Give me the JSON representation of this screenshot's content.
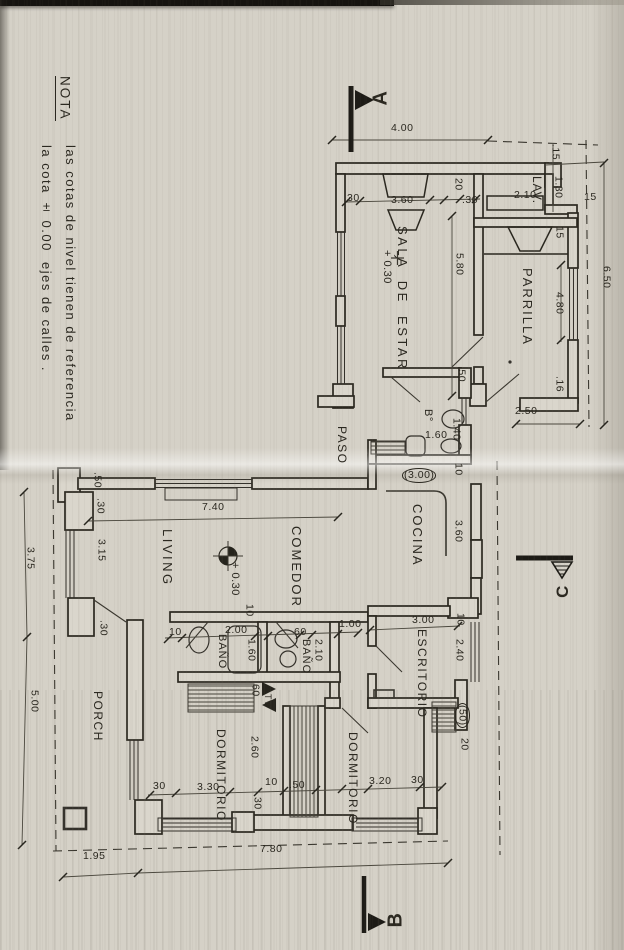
{
  "note": {
    "title": "NOTA",
    "line1": "las cotas de nivel tienen de referencia",
    "line2": "la cota ± 0.00  ejes de calles ."
  },
  "markers": {
    "a": "A",
    "b": "B",
    "c": "C"
  },
  "colors": {
    "ink": "#2b2820",
    "paper": "#d5d1c7"
  },
  "rooms": [
    {
      "t": "SALA  DE  ESTAR",
      "x": 396,
      "y": 226,
      "fs": 13,
      "ls": 2.5,
      "name": "room-label-sala-de-estar"
    },
    {
      "t": "LAV.",
      "x": 531,
      "y": 176,
      "fs": 12,
      "ls": 1,
      "name": "room-label-lavadero"
    },
    {
      "t": "PARRILLA",
      "x": 521,
      "y": 268,
      "fs": 13,
      "ls": 2,
      "name": "room-label-parrilla"
    },
    {
      "t": "PASO",
      "x": 336,
      "y": 426,
      "fs": 12,
      "ls": 1.5,
      "name": "room-label-paso"
    },
    {
      "t": "B°",
      "x": 422,
      "y": 409,
      "fs": 11,
      "ls": 0.5,
      "name": "room-label-banio-chico"
    },
    {
      "t": "COCINA",
      "x": 411,
      "y": 504,
      "fs": 13,
      "ls": 2,
      "name": "room-label-cocina"
    },
    {
      "t": "COMEDOR",
      "x": 290,
      "y": 526,
      "fs": 13,
      "ls": 2,
      "name": "room-label-comedor"
    },
    {
      "t": "LIVING",
      "x": 161,
      "y": 529,
      "fs": 13,
      "ls": 2.5,
      "name": "room-label-living"
    },
    {
      "t": "ESCRITORIO",
      "x": 416,
      "y": 629,
      "fs": 12,
      "ls": 1.5,
      "name": "room-label-escritorio"
    },
    {
      "t": "BAÑO",
      "x": 216,
      "y": 634,
      "fs": 11,
      "ls": 1,
      "name": "room-label-banio-1"
    },
    {
      "t": "BAÑO",
      "x": 300,
      "y": 639,
      "fs": 11,
      "ls": 1,
      "name": "room-label-banio-2"
    },
    {
      "t": "DORMITORIO",
      "x": 215,
      "y": 729,
      "fs": 12,
      "ls": 1.5,
      "name": "room-label-dormitorio-1"
    },
    {
      "t": "DORMITORIO",
      "x": 347,
      "y": 732,
      "fs": 12,
      "ls": 1.5,
      "name": "room-label-dormitorio-2"
    },
    {
      "t": "PORCH",
      "x": 92,
      "y": 691,
      "fs": 12,
      "ls": 1.5,
      "name": "room-label-porch"
    },
    {
      "t": "TV",
      "x": 263,
      "y": 694,
      "fs": 9,
      "ls": 0.5,
      "name": "label-tv-nook"
    }
  ],
  "levels": [
    {
      "t": "+ 0.30",
      "x": 381,
      "y": 250,
      "fs": 11,
      "name": "level-mark-sala"
    },
    {
      "t": "+ 0.30",
      "x": 229,
      "y": 562,
      "fs": 11,
      "name": "level-mark-living"
    }
  ],
  "dims_h": [
    {
      "t": "4.00",
      "x": 391,
      "y": 123
    },
    {
      "t": "30",
      "x": 347,
      "y": 193
    },
    {
      "t": "3.60",
      "x": 391,
      "y": 195
    },
    {
      "t": ".30",
      "x": 462,
      "y": 195
    },
    {
      "t": "2.10",
      "x": 514,
      "y": 190
    },
    {
      "t": "15",
      "x": 584,
      "y": 192
    },
    {
      "t": "2.50",
      "x": 515,
      "y": 406
    },
    {
      "t": "1.60",
      "x": 425,
      "y": 430
    },
    {
      "t": "(3.00)",
      "x": 402,
      "y": 468,
      "oval": true
    },
    {
      "t": "7.40",
      "x": 202,
      "y": 502
    },
    {
      "t": "10",
      "x": 169,
      "y": 627
    },
    {
      "t": "2.00",
      "x": 225,
      "y": 625
    },
    {
      "t": "60",
      "x": 294,
      "y": 627
    },
    {
      "t": "1.00",
      "x": 339,
      "y": 619
    },
    {
      "t": "3.00",
      "x": 412,
      "y": 615
    },
    {
      "t": "30",
      "x": 153,
      "y": 781
    },
    {
      "t": "3.30",
      "x": 197,
      "y": 782
    },
    {
      "t": "10",
      "x": 265,
      "y": 777
    },
    {
      "t": ".50",
      "x": 289,
      "y": 780
    },
    {
      "t": "3.20",
      "x": 369,
      "y": 776
    },
    {
      "t": "30",
      "x": 411,
      "y": 775
    },
    {
      "t": "1.95",
      "x": 83,
      "y": 851
    },
    {
      "t": "7.80",
      "x": 260,
      "y": 844
    }
  ],
  "dims_v": [
    {
      "t": ".15",
      "x": 550,
      "y": 144
    },
    {
      "t": "1.30",
      "x": 553,
      "y": 176
    },
    {
      "t": "15",
      "x": 554,
      "y": 226
    },
    {
      "t": "20",
      "x": 453,
      "y": 178
    },
    {
      "t": "5.80",
      "x": 454,
      "y": 253
    },
    {
      "t": ".50",
      "x": 456,
      "y": 366
    },
    {
      "t": "6.50",
      "x": 601,
      "y": 266
    },
    {
      "t": "4.80",
      "x": 554,
      "y": 292
    },
    {
      "t": ".16",
      "x": 554,
      "y": 376
    },
    {
      "t": "1.40",
      "x": 451,
      "y": 418
    },
    {
      "t": "10",
      "x": 453,
      "y": 463
    },
    {
      "t": "3.60",
      "x": 453,
      "y": 520
    },
    {
      "t": ".50",
      "x": 92,
      "y": 472
    },
    {
      "t": ".30",
      "x": 95,
      "y": 498
    },
    {
      "t": "3.15",
      "x": 96,
      "y": 539
    },
    {
      "t": ".30",
      "x": 98,
      "y": 620
    },
    {
      "t": "10",
      "x": 244,
      "y": 604
    },
    {
      "t": "1.60",
      "x": 246,
      "y": 639
    },
    {
      "t": "2.10",
      "x": 313,
      "y": 639
    },
    {
      "t": "60",
      "x": 250,
      "y": 684
    },
    {
      "t": "2.60",
      "x": 249,
      "y": 736
    },
    {
      "t": "30",
      "x": 252,
      "y": 797
    },
    {
      "t": "2.40",
      "x": 454,
      "y": 639
    },
    {
      "t": "(50)",
      "x": 455,
      "y": 703,
      "oval": true
    },
    {
      "t": "20",
      "x": 459,
      "y": 738
    },
    {
      "t": "10",
      "x": 455,
      "y": 613
    },
    {
      "t": "3.75",
      "x": 25,
      "y": 547
    },
    {
      "t": "5.00",
      "x": 29,
      "y": 690
    }
  ]
}
